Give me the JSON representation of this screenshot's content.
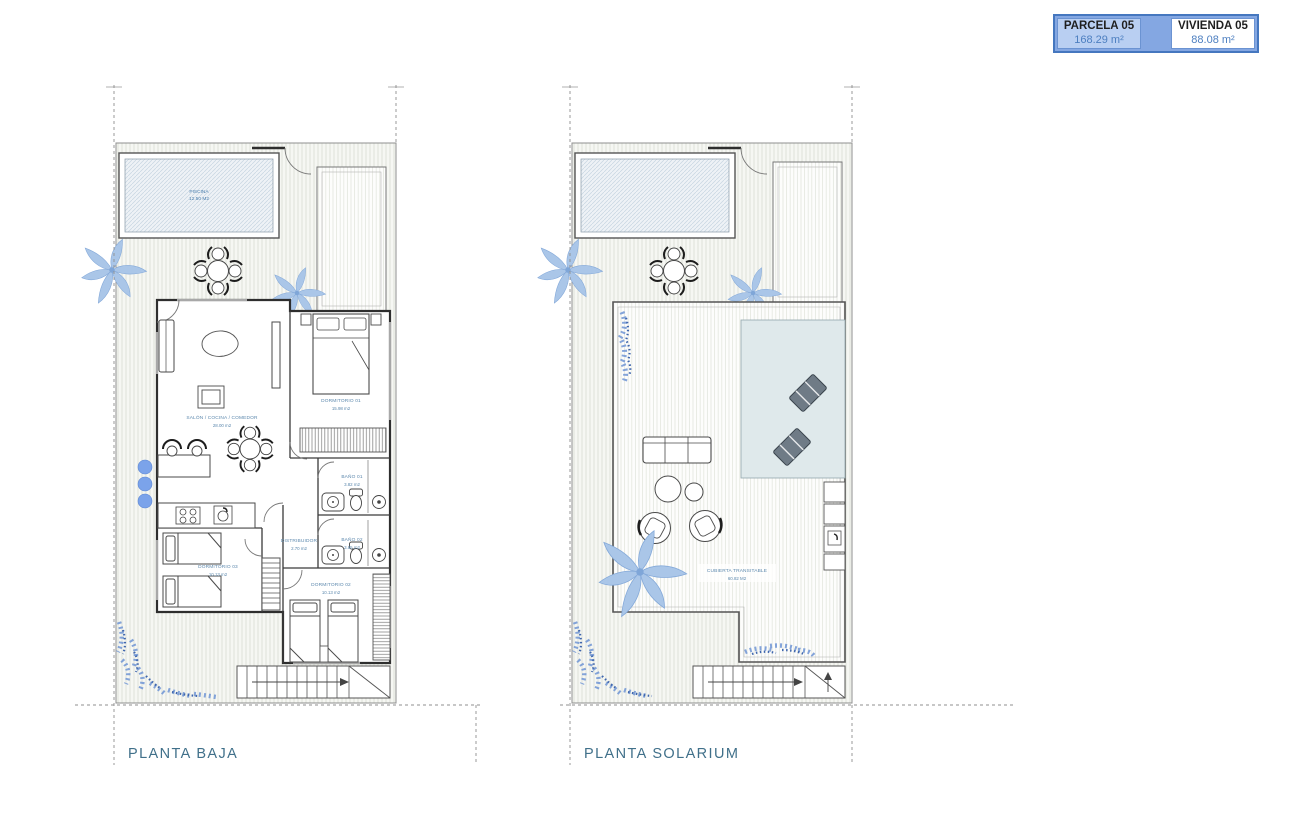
{
  "legend": {
    "parcela": {
      "label": "PARCELA 05",
      "value": "168.29 m²"
    },
    "vivienda": {
      "label": "VIVIENDA 05",
      "value": "88.08 m²"
    }
  },
  "plans": {
    "baja": {
      "title": "PLANTA BAJA",
      "piscina": {
        "name": "PISCINA",
        "area": "12.50 M2"
      },
      "salon": {
        "name": "SALÓN / COCINA / COMEDOR",
        "area": "28.00 m2"
      },
      "dorm1": {
        "name": "DORMITORIO 01",
        "area": "15.98 m2"
      },
      "bano1": {
        "name": "BAÑO 01",
        "area": "3.82 m2"
      },
      "bano2": {
        "name": "BAÑO 02",
        "area": "3.85 m2"
      },
      "distribuidor": {
        "name": "DISTRIBUIDOR",
        "area": "2.70 m2"
      },
      "dorm3": {
        "name": "DORMITORIO 03",
        "area": "10.13 m2"
      },
      "dorm2": {
        "name": "DORMITORIO 02",
        "area": "10.13 m2"
      }
    },
    "solarium": {
      "title": "PLANTA SOLARIUM",
      "cubierta": {
        "name": "CUBIERTA TRANSITABLE",
        "area": "60.82 M2"
      }
    }
  },
  "colors": {
    "legend_border": "#4577bf",
    "legend_fill": "#b9cff2",
    "legend_value_text": "#4d7fc0",
    "room_label_text": "#5c88ad",
    "title_text": "#40708a",
    "wall_line": "#2e2e2e",
    "palm_blue": "#aac6e8",
    "shrub_blue": "#5f86cc",
    "pergola_tint": "#dfe9eb"
  }
}
